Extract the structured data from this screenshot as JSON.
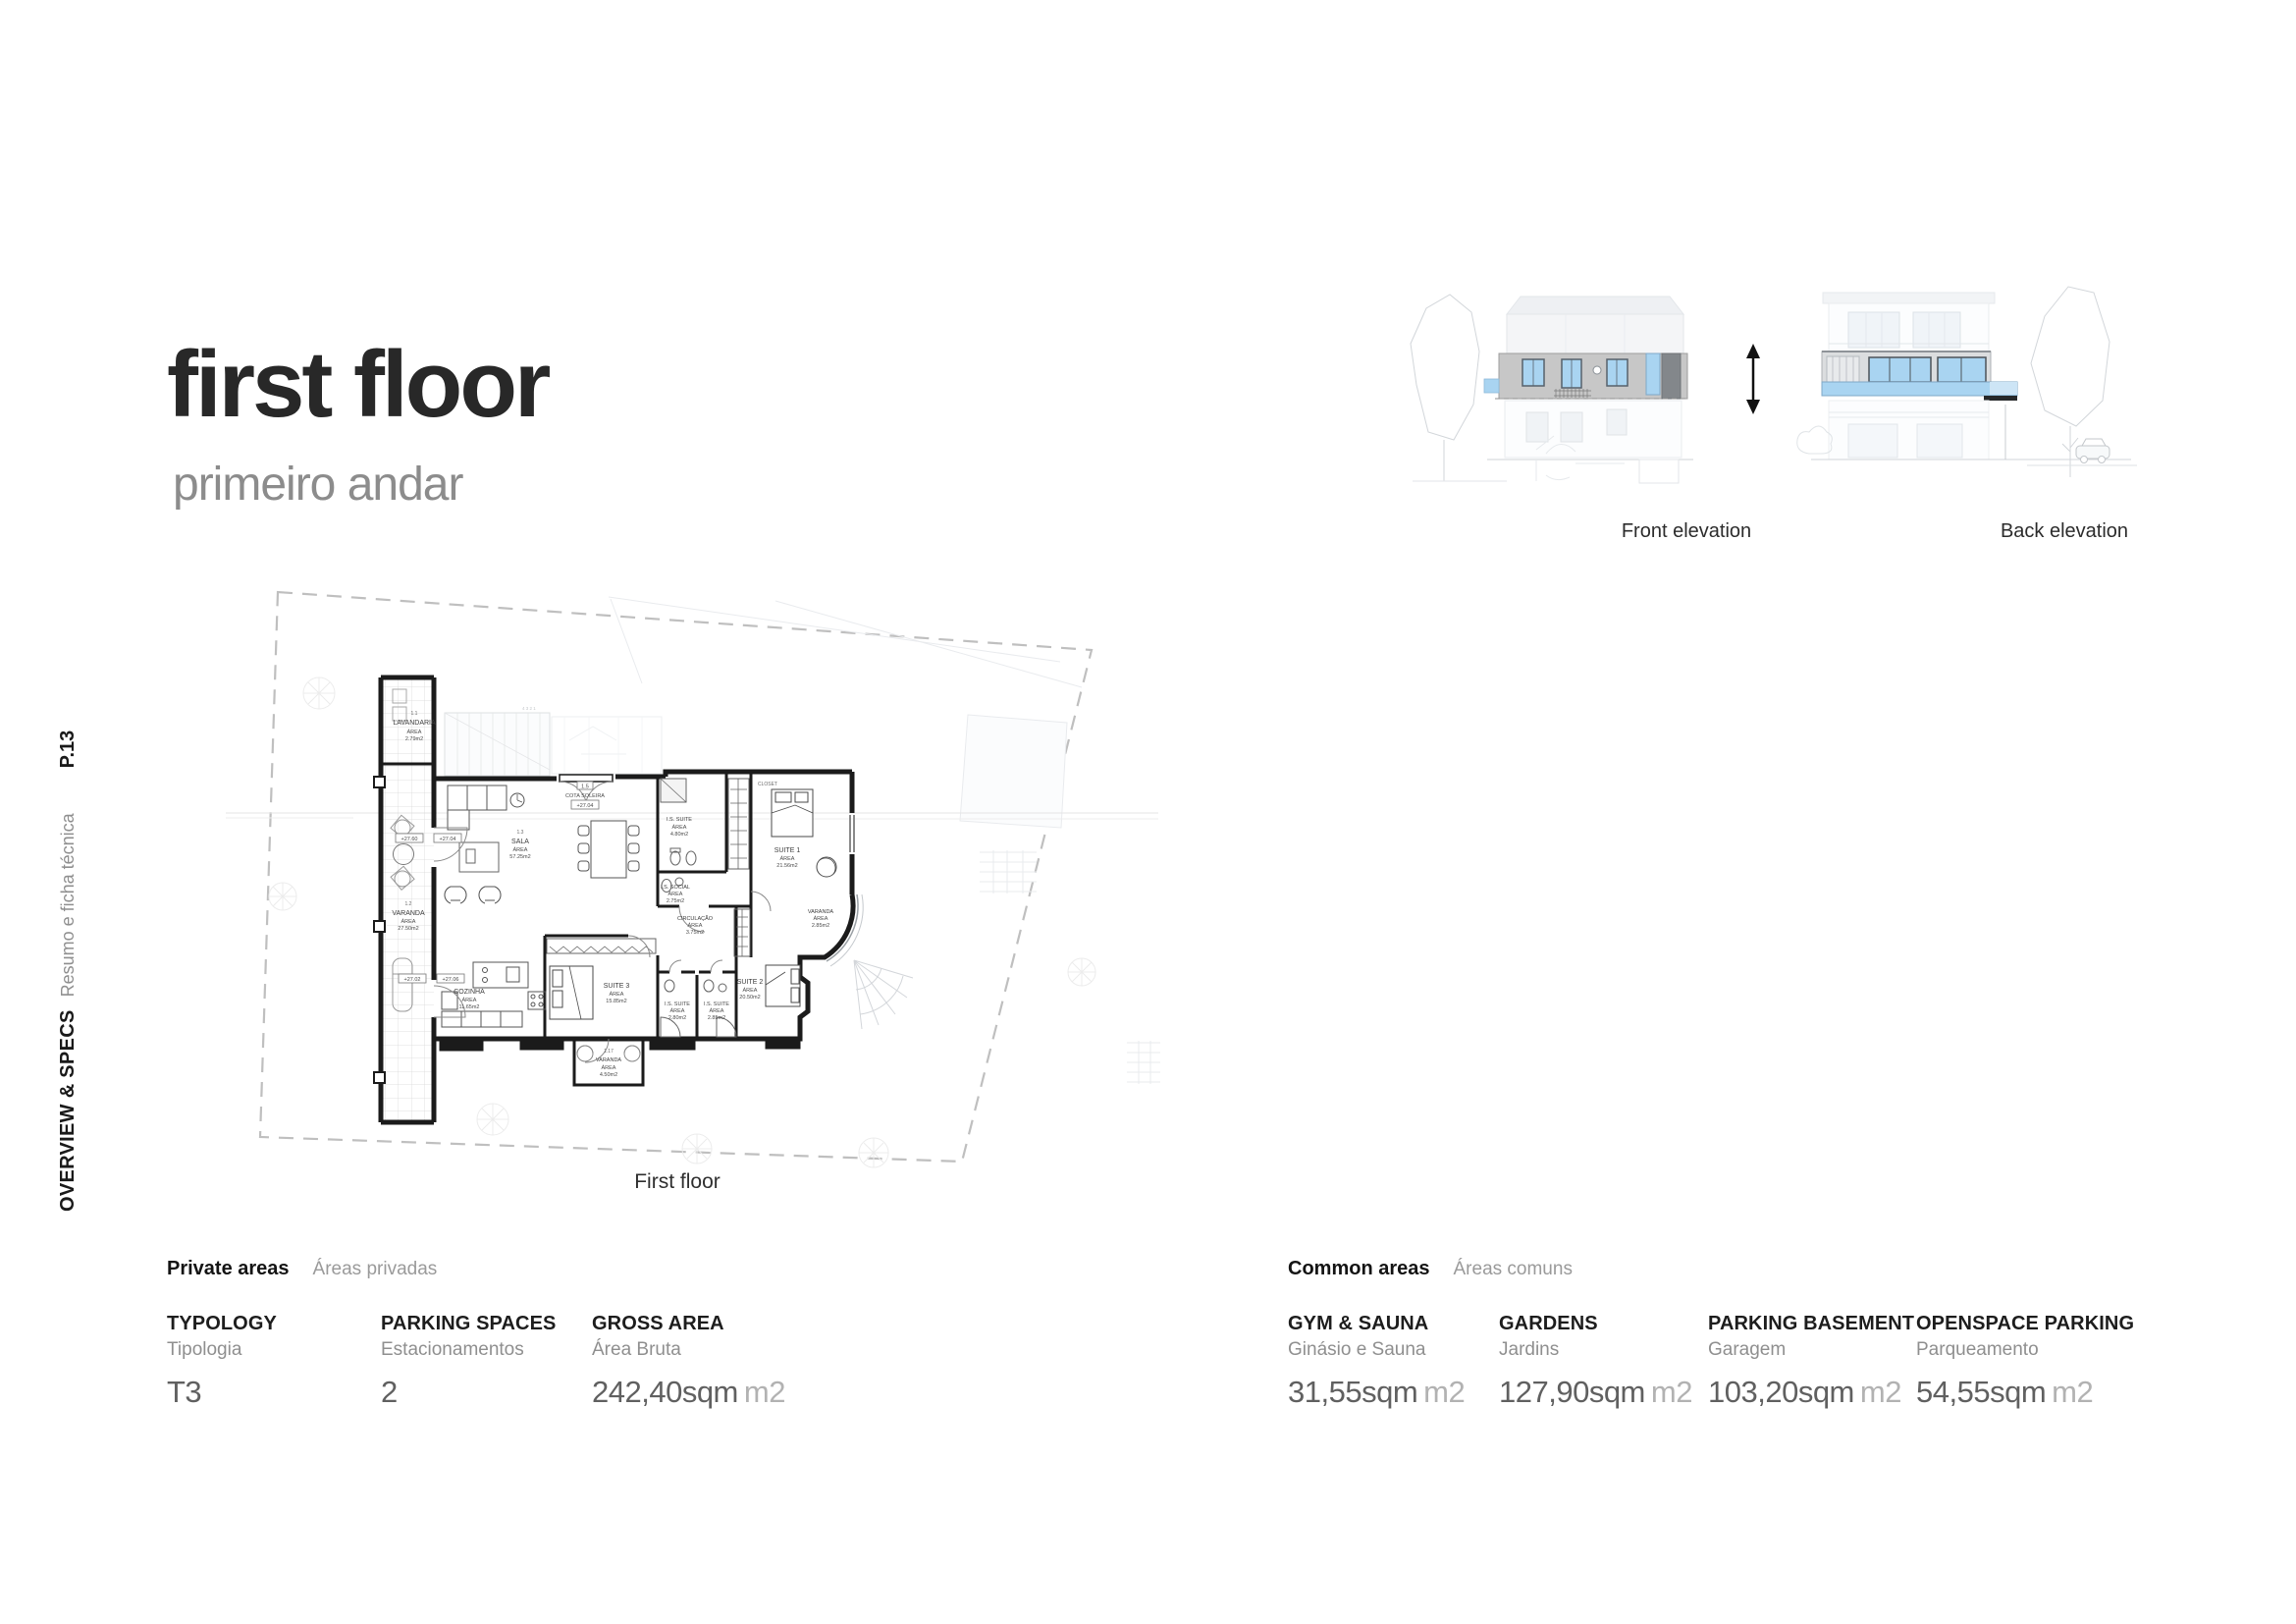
{
  "header": {
    "title": "first floor",
    "subtitle": "primeiro andar"
  },
  "sidebar": {
    "section": "OVERVIEW & SPECS",
    "section_sub": "Resumo e ficha técnica",
    "page": "P.13"
  },
  "elevations": {
    "front_label": "Front elevation",
    "back_label": "Back elevation"
  },
  "plan": {
    "caption": "First floor",
    "area_word": "ÁREA",
    "stair_numbers": "4  3  2  1",
    "cota": {
      "code": "1.5",
      "label": "COTA SOLEIRA",
      "value": "+27.04"
    },
    "markers": {
      "m1": "+27.60",
      "m2": "+27.04",
      "m3": "+27.02",
      "m4": "+27.06"
    },
    "rooms": [
      {
        "code": "1.1",
        "name": "LAVANDARIA",
        "area": "2.79m2"
      },
      {
        "code": "1.2",
        "name": "VARANDA",
        "area": "27.50m2"
      },
      {
        "code": "1.3",
        "name": "SALA",
        "area": "57.25m2"
      },
      {
        "name": "I.S. SUITE",
        "area": "4.80m2"
      },
      {
        "name": "CLOSET"
      },
      {
        "name": "SUITE 1",
        "area": "21.56m2"
      },
      {
        "name": "I.S. SOCIAL",
        "area": "2.75m2"
      },
      {
        "name": "CIRCULAÇÃO",
        "area": "3.75m2"
      },
      {
        "name": "VARANDA",
        "area": "2.85m2"
      },
      {
        "name": "COZINHA",
        "area": "11.65m2"
      },
      {
        "name": "SUITE 3",
        "area": "15.85m2"
      },
      {
        "name": "I.S. SUITE",
        "area": "2.80m2"
      },
      {
        "name": "I.S. SUITE",
        "area": "2.85m2"
      },
      {
        "name": "SUITE 2",
        "area": "20.50m2"
      },
      {
        "code": "1.17",
        "name": "VARANDA",
        "area": "4.50m2"
      }
    ]
  },
  "specs": {
    "private": {
      "title": "Private areas",
      "subtitle": "Áreas privadas",
      "columns": [
        {
          "label": "TYPOLOGY",
          "sublabel": "Tipologia",
          "value": "T3",
          "unit": ""
        },
        {
          "label": "PARKING SPACES",
          "sublabel": "Estacionamentos",
          "value": "2",
          "unit": ""
        },
        {
          "label": "GROSS AREA",
          "sublabel": "Área Bruta",
          "value": "242,40sqm",
          "unit": "m2"
        }
      ]
    },
    "common": {
      "title": "Common areas",
      "subtitle": "Áreas comuns",
      "columns": [
        {
          "label": "GYM & SAUNA",
          "sublabel": "Ginásio e Sauna",
          "value": "31,55sqm",
          "unit": "m2"
        },
        {
          "label": "GARDENS",
          "sublabel": "Jardins",
          "value": "127,90sqm",
          "unit": "m2"
        },
        {
          "label": "PARKING BASEMENT",
          "sublabel": "Garagem",
          "value": "103,20sqm",
          "unit": "m2"
        },
        {
          "label": "OPENSPACE PARKING",
          "sublabel": "Parqueamento",
          "value": "54,55sqm",
          "unit": "m2"
        }
      ]
    }
  },
  "colors": {
    "accent_blue": "#a9d4f1",
    "facade_gray": "#c7c7c7",
    "slab_dark": "#83878b",
    "wall_black": "#1b1b1b"
  }
}
